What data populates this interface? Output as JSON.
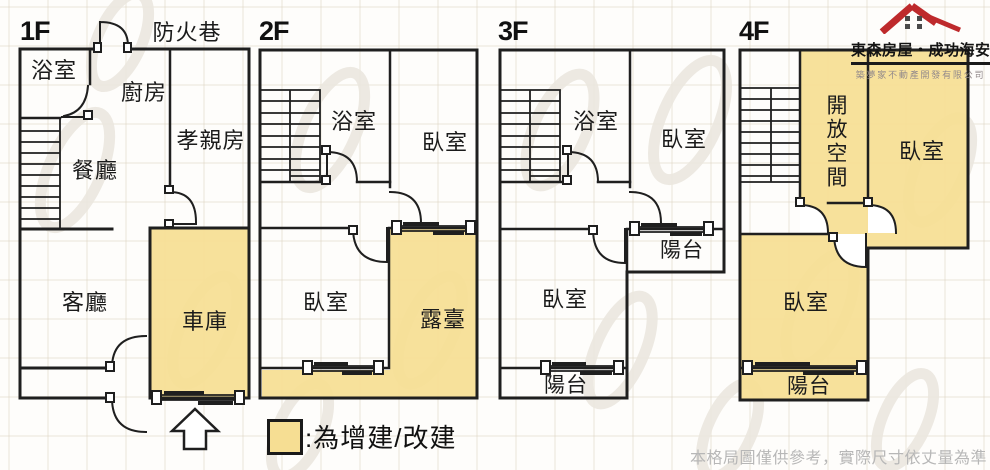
{
  "colors": {
    "highlight_yellow": "#F6DE93",
    "wall": "#1F1F1F",
    "logo_red": "#BE2A2C",
    "disclaimer_text": "#B7B7B7"
  },
  "icons": {
    "logo_mark": "red-roof-house-icon",
    "entrance": "up-arrow-icon",
    "legend_swatch": "highlight-swatch"
  },
  "logo": {
    "title": "東森房屋・成功海安",
    "subtitle": "築夢家不動產開發有限公司"
  },
  "legend": {
    "label": ":為增建/改建"
  },
  "footer": {
    "disclaimer": "本格局圖僅供參考，實際尺寸依丈量為準"
  },
  "floors": [
    {
      "label": "1F",
      "outside_label": "防火巷",
      "rooms": [
        {
          "name": "浴室",
          "highlight": false
        },
        {
          "name": "廚房",
          "highlight": false
        },
        {
          "name": "孝親房",
          "highlight": false
        },
        {
          "name": "餐廳",
          "highlight": false
        },
        {
          "name": "客廳",
          "highlight": false
        },
        {
          "name": "車庫",
          "highlight": true
        }
      ]
    },
    {
      "label": "2F",
      "rooms": [
        {
          "name": "浴室",
          "highlight": false
        },
        {
          "name": "臥室",
          "highlight": false
        },
        {
          "name": "臥室",
          "highlight": false
        },
        {
          "name": "露臺",
          "highlight": true
        }
      ]
    },
    {
      "label": "3F",
      "rooms": [
        {
          "name": "浴室",
          "highlight": false
        },
        {
          "name": "臥室",
          "highlight": false
        },
        {
          "name": "陽台",
          "highlight": false
        },
        {
          "name": "臥室",
          "highlight": false
        },
        {
          "name": "陽台",
          "highlight": false
        }
      ]
    },
    {
      "label": "4F",
      "rooms": [
        {
          "name": "開放空間",
          "highlight": true
        },
        {
          "name": "臥室",
          "highlight": true
        },
        {
          "name": "臥室",
          "highlight": true
        },
        {
          "name": "陽台",
          "highlight": true
        }
      ]
    }
  ]
}
